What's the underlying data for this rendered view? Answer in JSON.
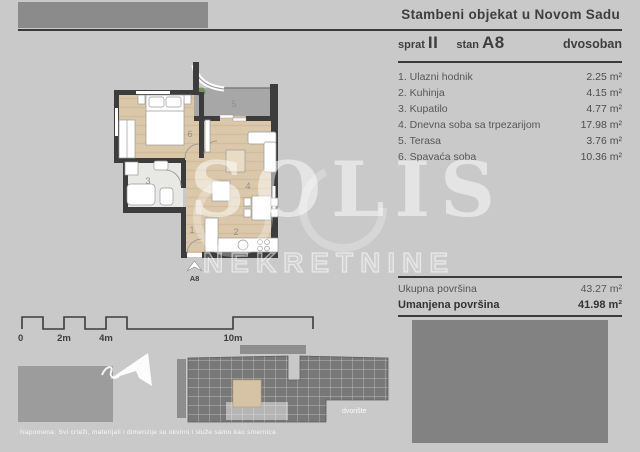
{
  "header": {
    "title": "Stambeni objekat u Novom Sadu",
    "floor_label": "sprat",
    "floor_value": "II",
    "unit_label": "stan",
    "unit_value": "A8",
    "type_value": "dvosoban"
  },
  "rooms": [
    {
      "name": "1. Ulazni hodnik",
      "area": "2.25 m²"
    },
    {
      "name": "2. Kuhinja",
      "area": "4.15 m²"
    },
    {
      "name": "3. Kupatilo",
      "area": "4.77 m²"
    },
    {
      "name": "4. Dnevna soba sa trpezarijom",
      "area": "17.98 m²"
    },
    {
      "name": "5. Terasa",
      "area": "3.76 m²"
    },
    {
      "name": "6. Spavaća soba",
      "area": "10.36 m²"
    }
  ],
  "totals": {
    "gross_label": "Ukupna površina",
    "gross_value": "43.27 m²",
    "net_label": "Umanjena površina",
    "net_value": "41.98 m²"
  },
  "floor_plan": {
    "numbers": {
      "r1": "1",
      "r2": "2",
      "r3": "3",
      "r4": "4",
      "r5": "5",
      "r6": "6"
    },
    "entry_label": "A8"
  },
  "watermark": {
    "name": "SOLIS",
    "subtitle": "NEKRETNINE"
  },
  "scale_bar": {
    "labels": [
      "0",
      "2m",
      "4m",
      "10m"
    ]
  },
  "site_plan": {
    "courtyard_label": "dvorište"
  },
  "footnote": "Napomena: Svi crteži, materijali i dimenzije su okvirni i služe samo kao smernica",
  "colors": {
    "background": "#c9c9c9",
    "wall": "#3c3c3c",
    "floor_wood": "#dbc8ab",
    "terrace": "#a7a7a7",
    "bar_gray": "#8b8b8b",
    "text_dark": "#3e3e3e"
  }
}
